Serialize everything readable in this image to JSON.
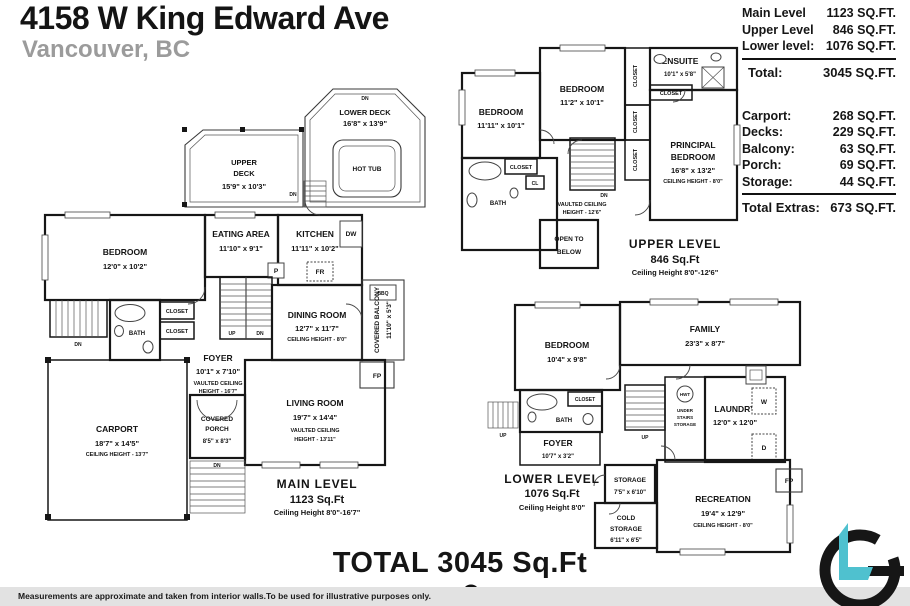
{
  "header": {
    "title": "4158 W King Edward Ave",
    "subtitle": "Vancouver, BC"
  },
  "summary": {
    "levels": [
      {
        "label": "Main Level",
        "value": "1123 SQ.FT."
      },
      {
        "label": "Upper Level",
        "value": "846 SQ.FT."
      },
      {
        "label": "Lower level:",
        "value": "1076 SQ.FT."
      }
    ],
    "total_label": "Total:",
    "total_value": "3045 SQ.FT.",
    "extras": [
      {
        "label": "Carport:",
        "value": "268 SQ.FT."
      },
      {
        "label": "Decks:",
        "value": "229 SQ.FT."
      },
      {
        "label": "Balcony:",
        "value": "63 SQ.FT."
      },
      {
        "label": "Porch:",
        "value": "69 SQ.FT."
      },
      {
        "label": "Storage:",
        "value": "44 SQ.FT."
      }
    ],
    "total_extras_label": "Total Extras:",
    "total_extras_value": "673 SQ.FT."
  },
  "tags": {
    "dn": "DN",
    "up": "UP",
    "dw": "DW",
    "fr": "FR",
    "p": "P",
    "bbq": "BBQ",
    "fp": "FP",
    "cl": "CL",
    "w": "W",
    "d": "D",
    "hwt": "HWT",
    "closet": "CLOSET",
    "bath": "BATH",
    "hot_tub": "HOT TUB"
  },
  "plans": {
    "main": {
      "lower_deck": {
        "l1": "LOWER DECK",
        "l2": "16'8\" x 13'9\""
      },
      "upper_deck": {
        "l1": "UPPER",
        "l2": "DECK",
        "l3": "15'9\" x 10'3\""
      },
      "bedroom": {
        "l1": "BEDROOM",
        "l2": "12'0\" x 10'2\""
      },
      "eating": {
        "l1": "EATING AREA",
        "l2": "11'10\" x 9'1\""
      },
      "kitchen": {
        "l1": "KITCHEN",
        "l2": "11'11\" x 10'2\""
      },
      "dining": {
        "l1": "DINING ROOM",
        "l2": "12'7\" x 11'7\"",
        "l3": "CEILING HEIGHT - 8'0\""
      },
      "balcony": {
        "l1": "COVERED BALCONY",
        "l2": "11'10\" x 5'3\""
      },
      "foyer": {
        "l1": "FOYER",
        "l2": "10'1\" x 7'10\"",
        "l3": "VAULTED CEILING",
        "l4": "HEIGHT - 16'7\""
      },
      "living": {
        "l1": "LIVING ROOM",
        "l2": "19'7\" x 14'4\"",
        "l3": "VAULTED CEILING",
        "l4": "HEIGHT - 13'11\""
      },
      "carport": {
        "l1": "CARPORT",
        "l2": "18'7\" x 14'5\"",
        "l3": "CEILING HEIGHT - 13'7\""
      },
      "porch": {
        "l1": "COVERED",
        "l2": "PORCH",
        "l3": "8'5\" x 8'3\""
      },
      "label": {
        "l1": "MAIN LEVEL",
        "l2": "1123 Sq.Ft",
        "l3": "Ceiling Height 8'0\"-16'7\""
      }
    },
    "upper": {
      "bedroom1": {
        "l1": "BEDROOM",
        "l2": "11'11\" x 10'1\""
      },
      "bedroom2": {
        "l1": "BEDROOM",
        "l2": "11'2\" x 10'1\""
      },
      "ensuite": {
        "l1": "ENSUITE",
        "l2": "10'1\" x 5'8\""
      },
      "principal": {
        "l1": "PRINCIPAL",
        "l2": "BEDROOM",
        "l3": "16'8\" x 13'2\"",
        "l4": "CEILING HEIGHT - 8'0\""
      },
      "vaulted": {
        "l1": "VAULTED CEILING",
        "l2": "HEIGHT - 12'6\""
      },
      "open_below": {
        "l1": "OPEN TO",
        "l2": "BELOW"
      },
      "label": {
        "l1": "UPPER LEVEL",
        "l2": "846 Sq.Ft",
        "l3": "Ceiling Height 8'0\"-12'6\""
      }
    },
    "lower": {
      "bedroom": {
        "l1": "BEDROOM",
        "l2": "10'4\" x 9'8\""
      },
      "family": {
        "l1": "FAMILY",
        "l2": "23'3\" x 8'7\""
      },
      "laundry": {
        "l1": "LAUNDRY",
        "l2": "12'0\" x 12'0\""
      },
      "under_stairs": {
        "l1": "UNDER",
        "l2": "STAIRS",
        "l3": "STORAGE"
      },
      "storage": {
        "l1": "STORAGE",
        "l2": "7'5\" x 6'10\""
      },
      "cold_storage": {
        "l1": "COLD",
        "l2": "STORAGE",
        "l3": "6'11\" x 6'5\""
      },
      "recreation": {
        "l1": "RECREATION",
        "l2": "19'4\" x 12'9\"",
        "l3": "CEILING HEIGHT - 8'0\""
      },
      "foyer": {
        "l1": "FOYER",
        "l2": "10'7\" x 3'2\""
      },
      "label": {
        "l1": "LOWER LEVEL",
        "l2": "1076 Sq.Ft",
        "l3": "Ceiling Height 8'0\""
      }
    }
  },
  "footer": {
    "total": "TOTAL 3045 Sq.Ft",
    "disclaimer": "Measurements are approximate and taken from interior walls.To be used for illustrative purposes only."
  },
  "colors": {
    "wall": "#161616",
    "accent_teal": "#4FC1CF",
    "subtitle_gray": "#9B9B9B",
    "footer_bar": "#E2E2E2"
  }
}
